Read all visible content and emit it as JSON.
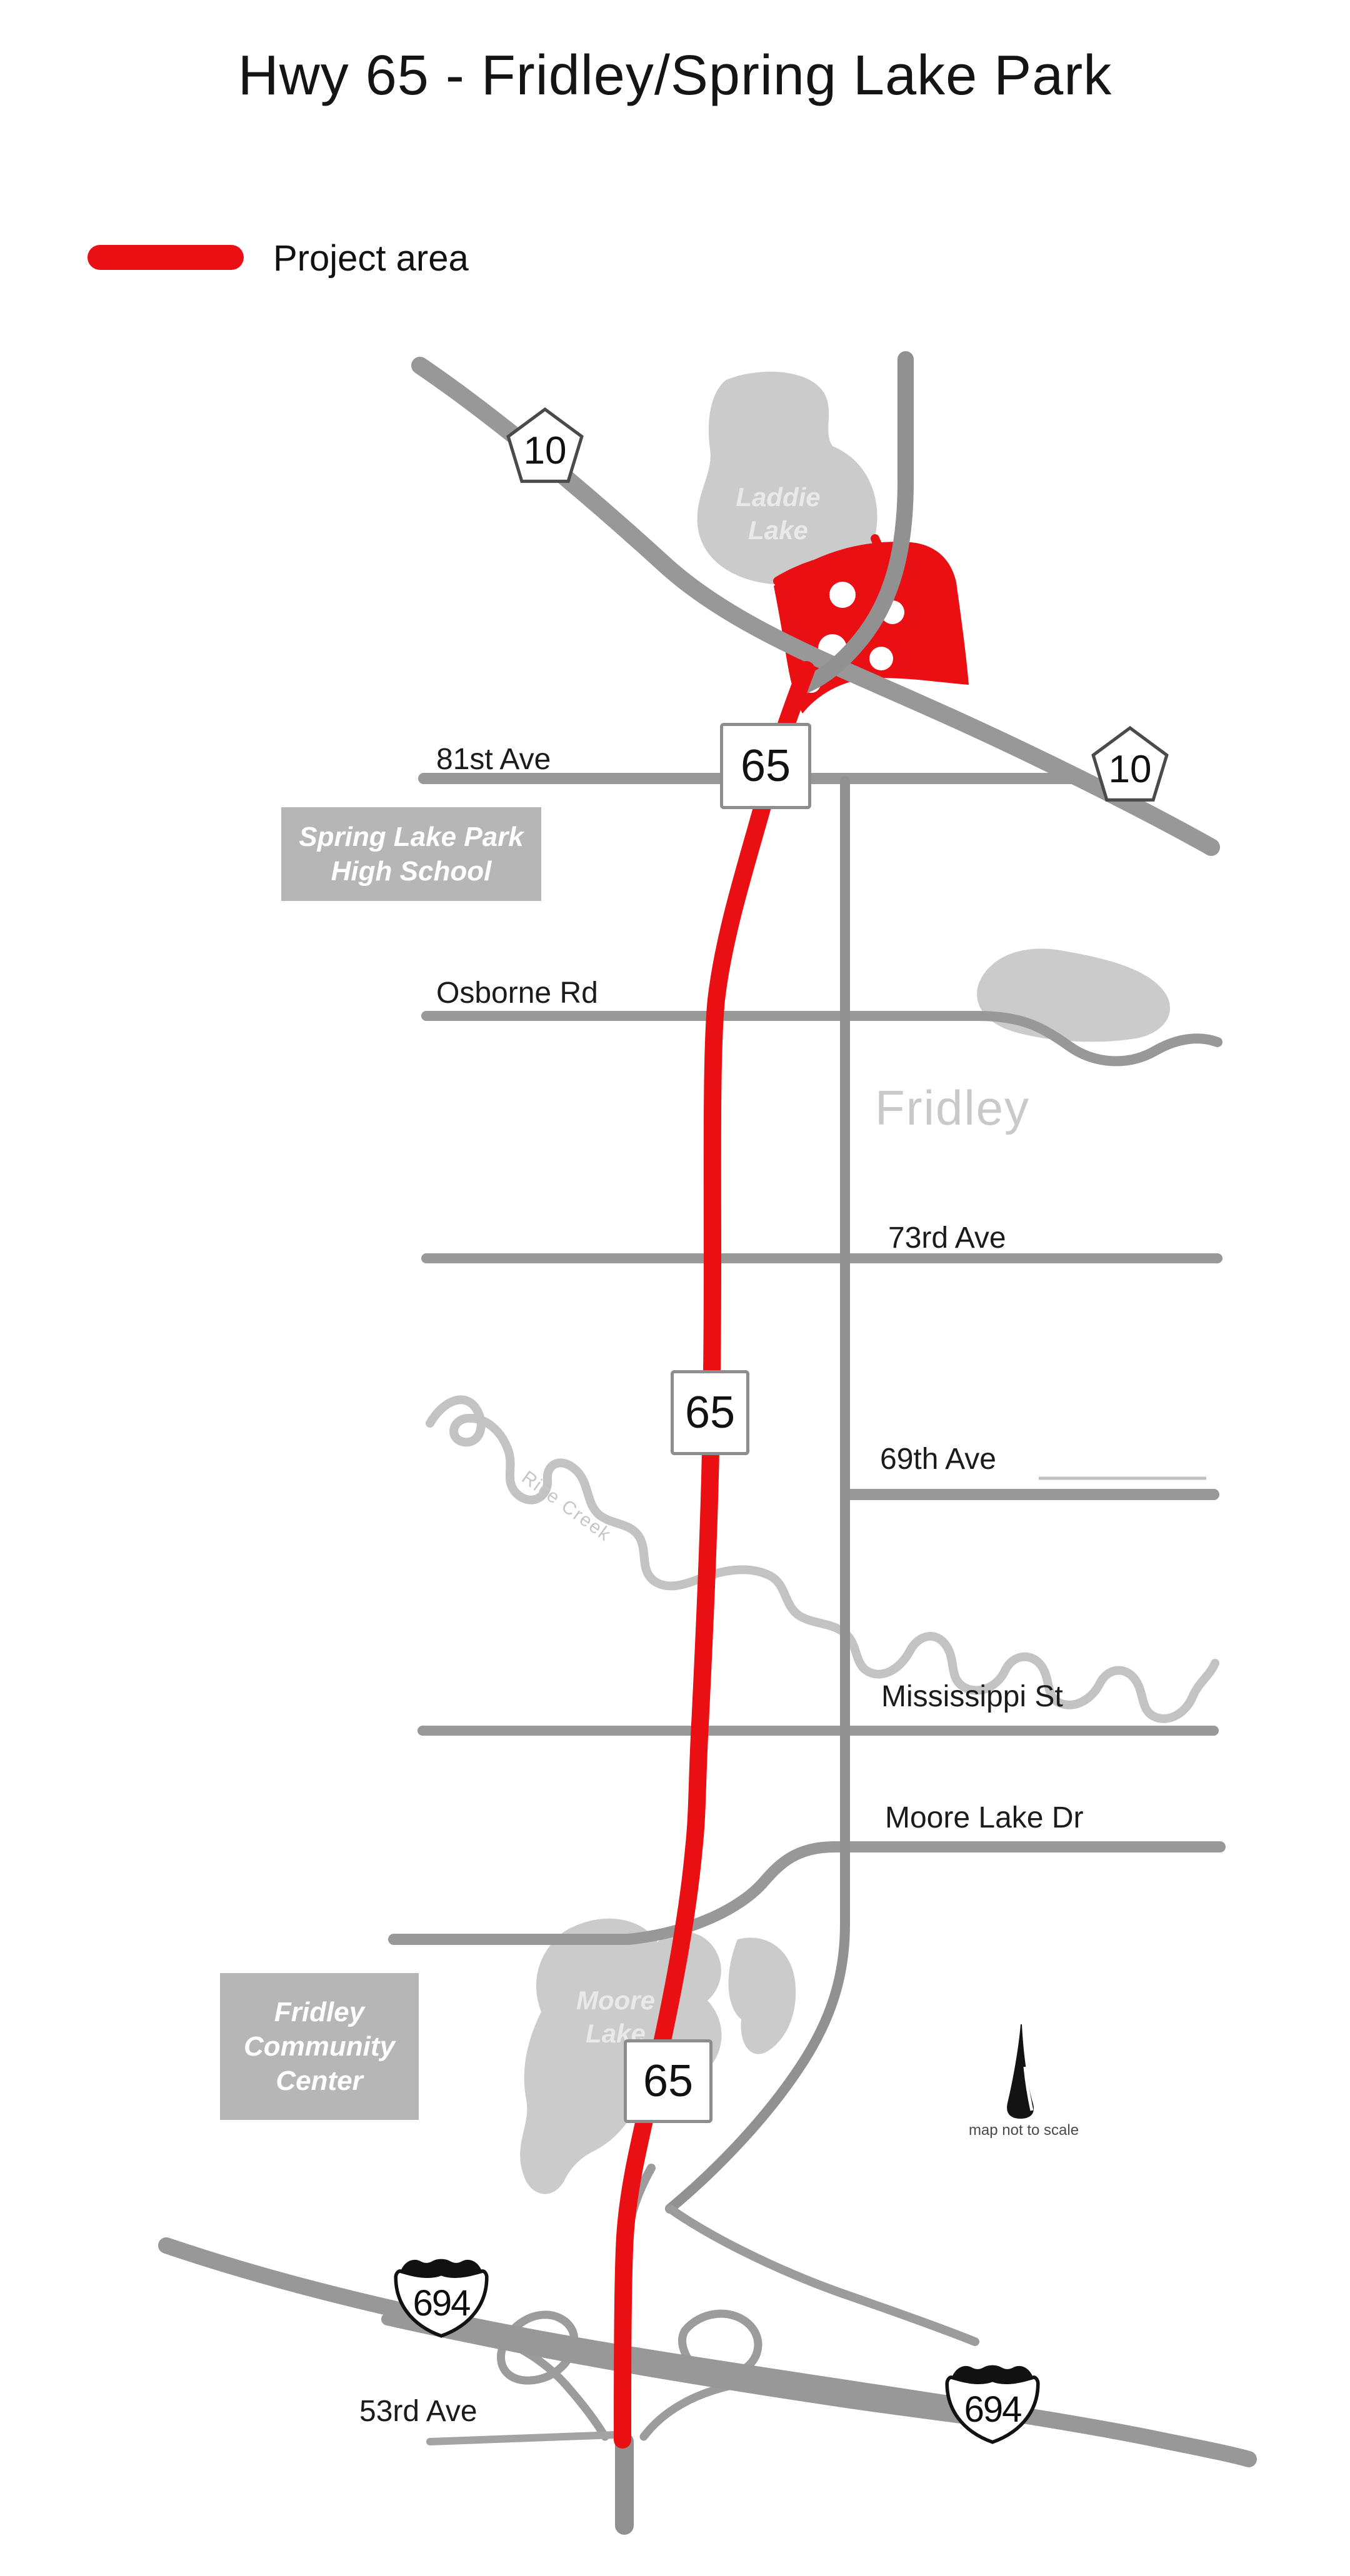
{
  "title": "Hwy 65 - Fridley/Spring Lake Park",
  "legend": {
    "label": "Project area"
  },
  "colors": {
    "project_red": "#e90f13",
    "road_gray": "#989898",
    "water_gray": "#cbcbcb",
    "label_box_gray": "#b6b6b6",
    "city_text_gray": "#c9c9c9"
  },
  "shields": {
    "hwy65": "65",
    "hwy10": "10",
    "i694": "694"
  },
  "streets": {
    "ave81": "81st Ave",
    "osborne": "Osborne Rd",
    "ave73": "73rd Ave",
    "ave69": "69th Ave",
    "mississippi": "Mississippi St",
    "moore_lake_dr": "Moore Lake Dr",
    "ave53": "53rd Ave"
  },
  "places": {
    "laddie_lake": "Laddie\nLake",
    "spring_lake_park_high_school": "Spring Lake Park\nHigh School",
    "fridley": "Fridley",
    "rice_creek": "Rice Creek",
    "moore_lake": "Moore\nLake",
    "fridley_community_center": "Fridley\nCommunity\nCenter"
  },
  "annotations": {
    "scale_note": "map not to scale"
  }
}
